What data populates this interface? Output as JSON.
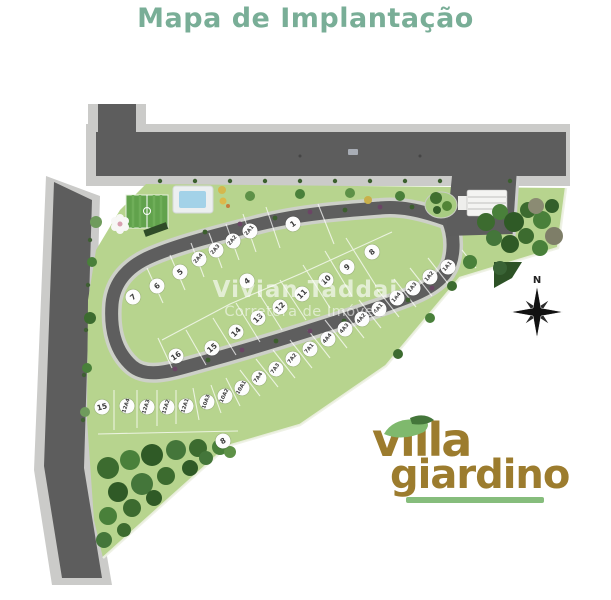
{
  "title": "Mapa de Implantação",
  "watermark": {
    "line1": "Vivian Taddai",
    "line2": "Corretora de Imóveis"
  },
  "compass": {
    "label": "N"
  },
  "logo": {
    "word1": "villa",
    "word2": "giardino"
  },
  "colors": {
    "title_green": "#79ae97",
    "logo_brown": "#9c7c2e",
    "leaf_green": "#7fb96d",
    "underline_green": "#86bd7c",
    "grass": "#b7d48e",
    "road_dark": "#5d5d5d",
    "sidewalk": "#cccccа",
    "woods": "#3c6b2f"
  },
  "map": {
    "lots": [
      {
        "label": "1",
        "x": 293,
        "y": 224,
        "rot": -35
      },
      {
        "label": "2A1",
        "x": 250,
        "y": 231,
        "rot": -50
      },
      {
        "label": "2A2",
        "x": 233,
        "y": 241,
        "rot": -50
      },
      {
        "label": "2A3",
        "x": 216,
        "y": 250,
        "rot": -50
      },
      {
        "label": "2A4",
        "x": 199,
        "y": 259,
        "rot": -50
      },
      {
        "label": "5",
        "x": 180,
        "y": 272,
        "rot": -40
      },
      {
        "label": "6",
        "x": 157,
        "y": 286,
        "rot": -40
      },
      {
        "label": "7",
        "x": 133,
        "y": 297,
        "rot": -40
      },
      {
        "label": "4",
        "x": 247,
        "y": 281,
        "rot": -40
      },
      {
        "label": "8",
        "x": 372,
        "y": 252,
        "rot": -40
      },
      {
        "label": "9",
        "x": 347,
        "y": 267,
        "rot": -40
      },
      {
        "label": "10",
        "x": 326,
        "y": 280,
        "rot": -45
      },
      {
        "label": "11",
        "x": 302,
        "y": 294,
        "rot": -45
      },
      {
        "label": "12",
        "x": 280,
        "y": 307,
        "rot": -45
      },
      {
        "label": "13",
        "x": 258,
        "y": 318,
        "rot": -45
      },
      {
        "label": "14",
        "x": 236,
        "y": 332,
        "rot": -45
      },
      {
        "label": "15",
        "x": 212,
        "y": 348,
        "rot": -40
      },
      {
        "label": "16",
        "x": 176,
        "y": 356,
        "rot": -35
      },
      {
        "label": "1A1",
        "x": 448,
        "y": 267,
        "rot": -50
      },
      {
        "label": "1A2",
        "x": 430,
        "y": 277,
        "rot": -50
      },
      {
        "label": "1A3",
        "x": 413,
        "y": 288,
        "rot": -50
      },
      {
        "label": "1A4",
        "x": 397,
        "y": 298,
        "rot": -50
      },
      {
        "label": "4A1",
        "x": 379,
        "y": 309,
        "rot": -50
      },
      {
        "label": "4A2",
        "x": 362,
        "y": 319,
        "rot": -50
      },
      {
        "label": "4A3",
        "x": 345,
        "y": 329,
        "rot": -50
      },
      {
        "label": "4A4",
        "x": 328,
        "y": 339,
        "rot": -50
      },
      {
        "label": "7A1",
        "x": 310,
        "y": 349,
        "rot": -50
      },
      {
        "label": "7A2",
        "x": 293,
        "y": 359,
        "rot": -52
      },
      {
        "label": "7A3",
        "x": 276,
        "y": 369,
        "rot": -55
      },
      {
        "label": "7A4",
        "x": 259,
        "y": 378,
        "rot": -55
      },
      {
        "label": "10A1",
        "x": 242,
        "y": 388,
        "rot": -60
      },
      {
        "label": "10A2",
        "x": 225,
        "y": 396,
        "rot": -65
      },
      {
        "label": "10A3",
        "x": 207,
        "y": 402,
        "rot": -70
      },
      {
        "label": "12A1",
        "x": 186,
        "y": 406,
        "rot": -72
      },
      {
        "label": "12A2",
        "x": 167,
        "y": 407,
        "rot": -72
      },
      {
        "label": "12A3",
        "x": 147,
        "y": 407,
        "rot": -72
      },
      {
        "label": "12A4",
        "x": 127,
        "y": 406,
        "rot": -72
      },
      {
        "label": "15",
        "x": 102,
        "y": 407,
        "rot": -15
      },
      {
        "label": "8",
        "x": 223,
        "y": 441,
        "rot": -30
      }
    ]
  }
}
